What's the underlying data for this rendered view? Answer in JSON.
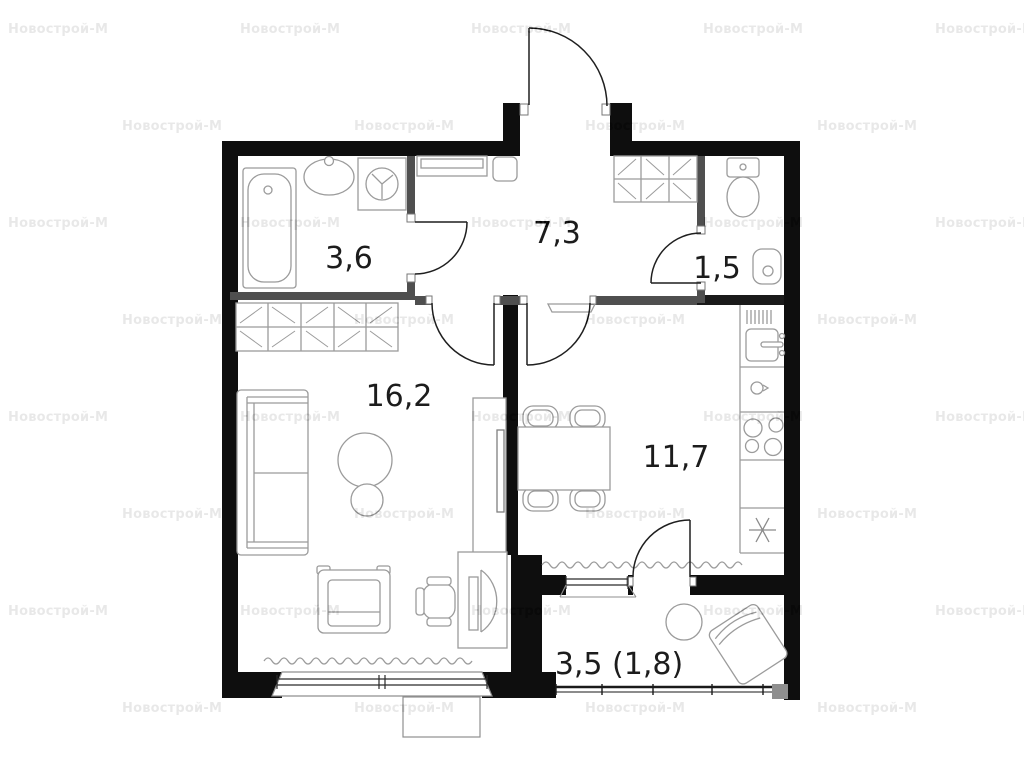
{
  "watermark": {
    "text": "Новострой-М"
  },
  "rooms": [
    {
      "name": "bathroom",
      "area": "3,6"
    },
    {
      "name": "hallway",
      "area": "7,3"
    },
    {
      "name": "wc",
      "area": "1,5"
    },
    {
      "name": "living-room",
      "area": "16,2"
    },
    {
      "name": "kitchen",
      "area": "11,7"
    },
    {
      "name": "balcony",
      "area": "3,5 (1,8)"
    }
  ],
  "fixtures": [
    "bathtub",
    "bathroom-sink",
    "washing-machine",
    "toilet",
    "wc-sink",
    "hall-bench",
    "hall-stool",
    "hall-wardrobe",
    "living-wardrobe",
    "sofa",
    "pouf",
    "tv-stand",
    "tv",
    "armchair",
    "desk",
    "monitor",
    "office-chair",
    "dining-table",
    "dining-chairs",
    "kitchen-counter",
    "kitchen-sink",
    "kettle",
    "stove-burners",
    "fridge-snowflake",
    "radiators",
    "balcony-table",
    "lounge-chair"
  ],
  "colors": {
    "background": "#ffffff",
    "outer_wall": "#0e0e0e",
    "inner_wall": "#4f4f4f",
    "furniture_stroke": "#9b9b9b",
    "door_stroke": "#1f1f1f",
    "label_text": "#1c1c1c",
    "watermark_on_white": "#e8e8e8"
  }
}
